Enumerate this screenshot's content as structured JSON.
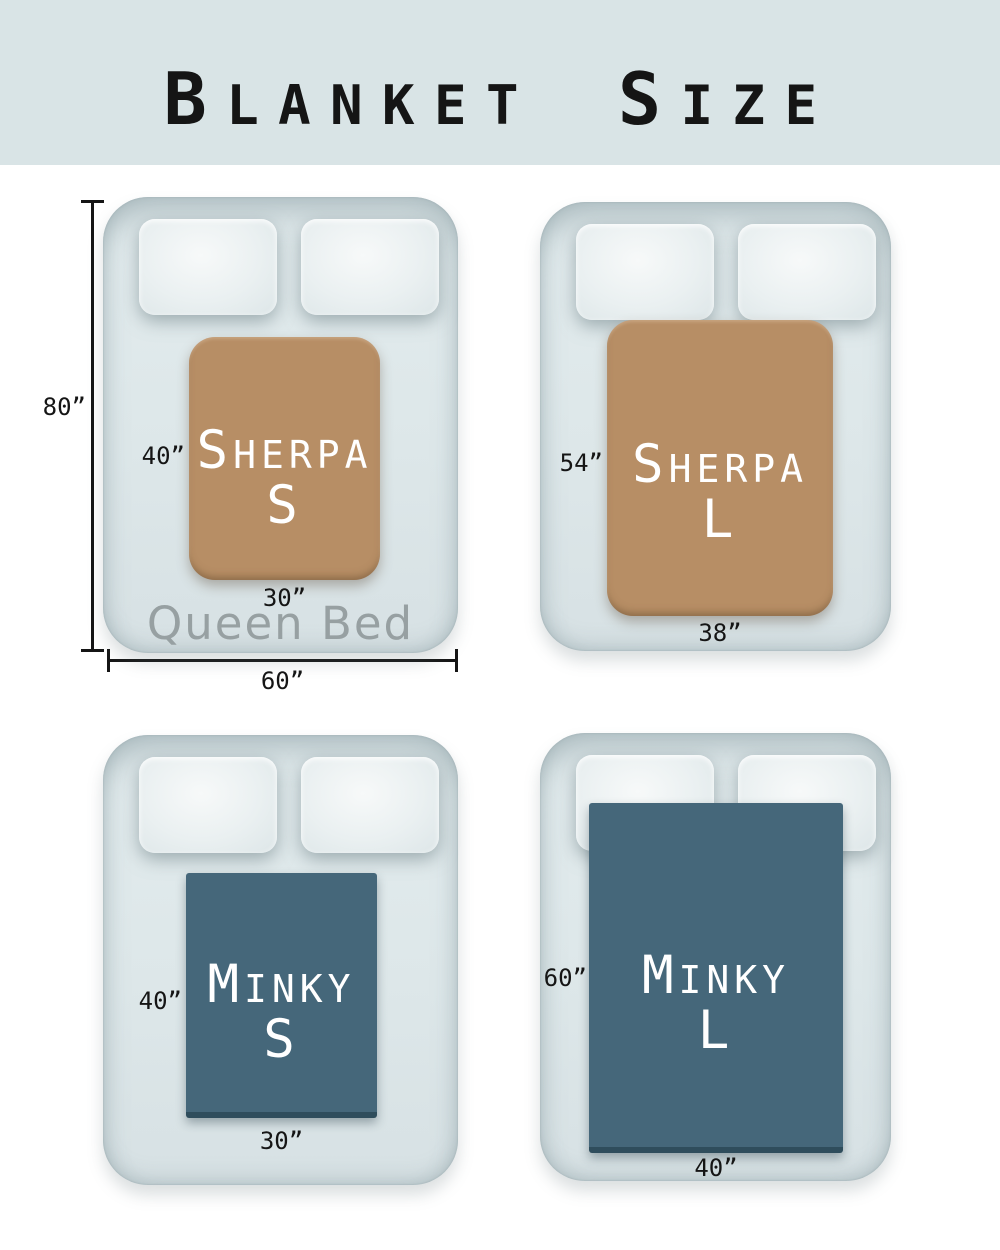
{
  "title": {
    "word1": "Blanket",
    "word2": "size"
  },
  "colors": {
    "banner": "#d9e4e6",
    "bed": "#dde7e9",
    "pillow": "#eaf0f1",
    "sherpa": "#b78e65",
    "minky": "#45677a",
    "blanket_text": "#ffffff",
    "bed_label": "#97a0a2",
    "ink": "#151515"
  },
  "queen_bed": {
    "name": "Queen Bed",
    "height_label": "80”",
    "width_label": "60”"
  },
  "blankets": {
    "sherpa_s": {
      "line1": "Sherpa",
      "line2": "S",
      "height_label": "40”",
      "width_label": "30”"
    },
    "sherpa_l": {
      "line1": "Sherpa",
      "line2": "L",
      "height_label": "54”",
      "width_label": "38”"
    },
    "minky_s": {
      "line1": "Minky",
      "line2": "S",
      "height_label": "40”",
      "width_label": "30”"
    },
    "minky_l": {
      "line1": "Minky",
      "line2": "L",
      "height_label": "60”",
      "width_label": "40”"
    }
  }
}
